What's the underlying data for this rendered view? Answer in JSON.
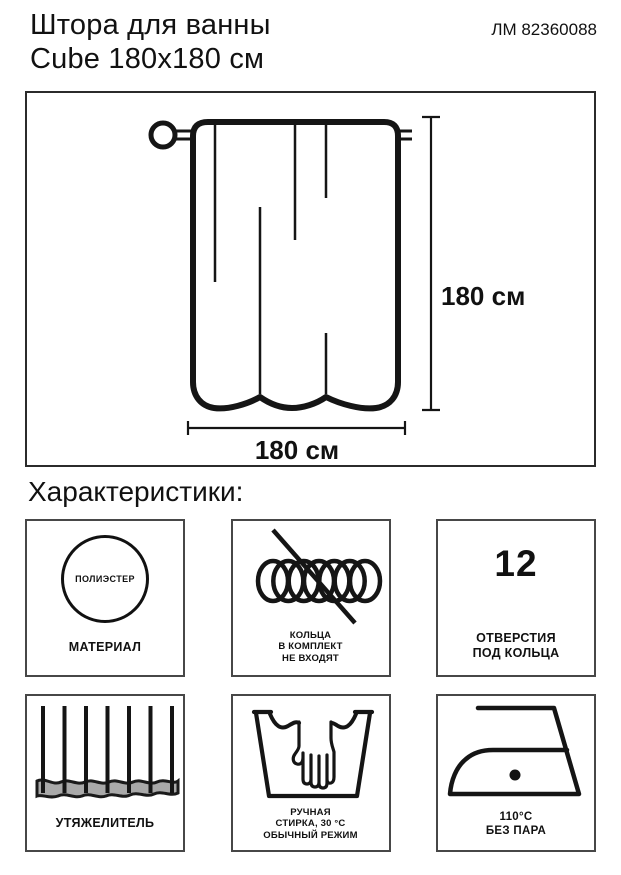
{
  "header": {
    "title_line1": "Штора для ванны",
    "title_line2": "Cube 180x180 см",
    "article": "ЛМ 82360088"
  },
  "diagram": {
    "height_label": "180 см",
    "width_label": "180 см"
  },
  "section_heading": "Характеристики:",
  "features": {
    "material": {
      "icon_text": "ПОЛИЭСТЕР",
      "label": "МАТЕРИАЛ"
    },
    "rings": {
      "lines": [
        "КОЛЬЦА",
        "В КОМПЛЕКТ",
        "НЕ ВХОДЯТ"
      ]
    },
    "holes": {
      "value": "12",
      "lines": [
        "ОТВЕРСТИЯ",
        "ПОД КОЛЬЦА"
      ]
    },
    "weight": {
      "label": "УТЯЖЕЛИТЕЛЬ"
    },
    "wash": {
      "lines": [
        "РУЧНАЯ",
        "СТИРКА, 30 °C",
        "ОБЫЧНЫЙ РЕЖИМ"
      ]
    },
    "iron": {
      "lines": [
        "110°C",
        "БЕЗ ПАРА"
      ]
    }
  },
  "colors": {
    "ink": "#151515",
    "box_border": "#474747",
    "weight_fill": "#a9a9a9"
  }
}
